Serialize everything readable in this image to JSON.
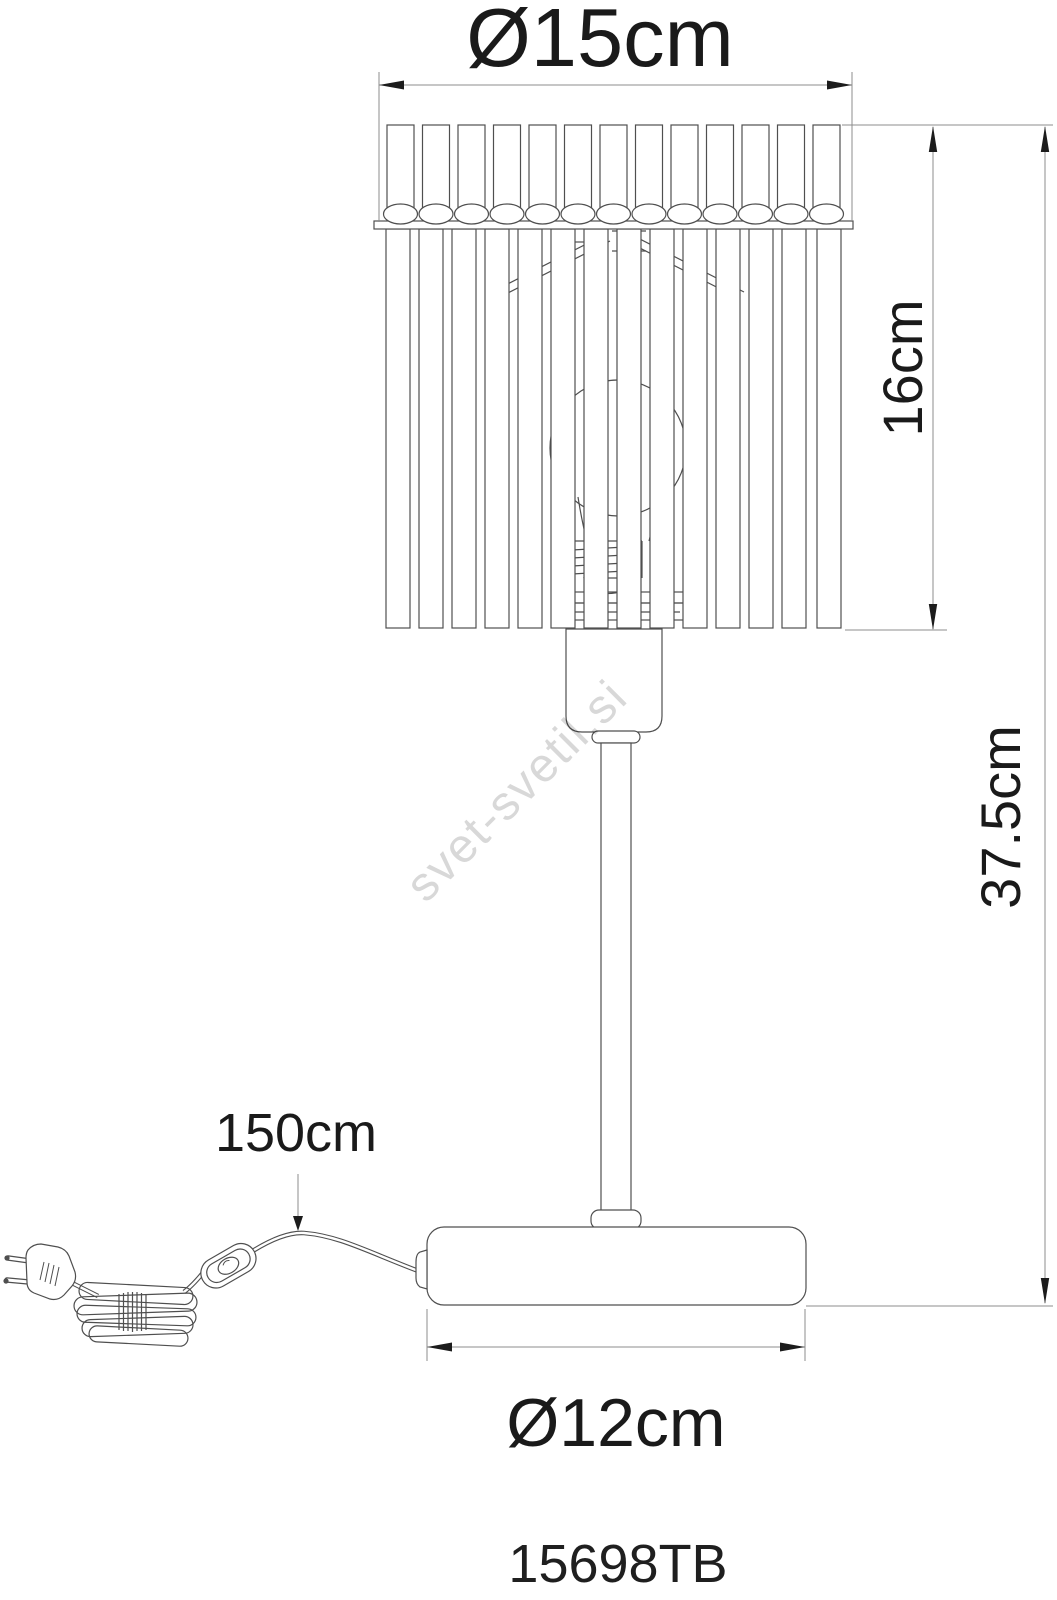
{
  "drawing": {
    "product_code": "15698TB",
    "watermark": "svet-svetil.si",
    "dimensions": {
      "shade_diameter": "Ø15cm",
      "shade_height": "16cm",
      "total_height": "37.5cm",
      "cord_length": "150cm",
      "base_diameter": "Ø12cm"
    },
    "colors": {
      "background": "#ffffff",
      "outline": "#4f4f4f",
      "dimension_line": "#8c8c8c",
      "arrow": "#1c1c1c",
      "text": "#1a1a1a",
      "watermark": "#d8d8d8"
    }
  }
}
